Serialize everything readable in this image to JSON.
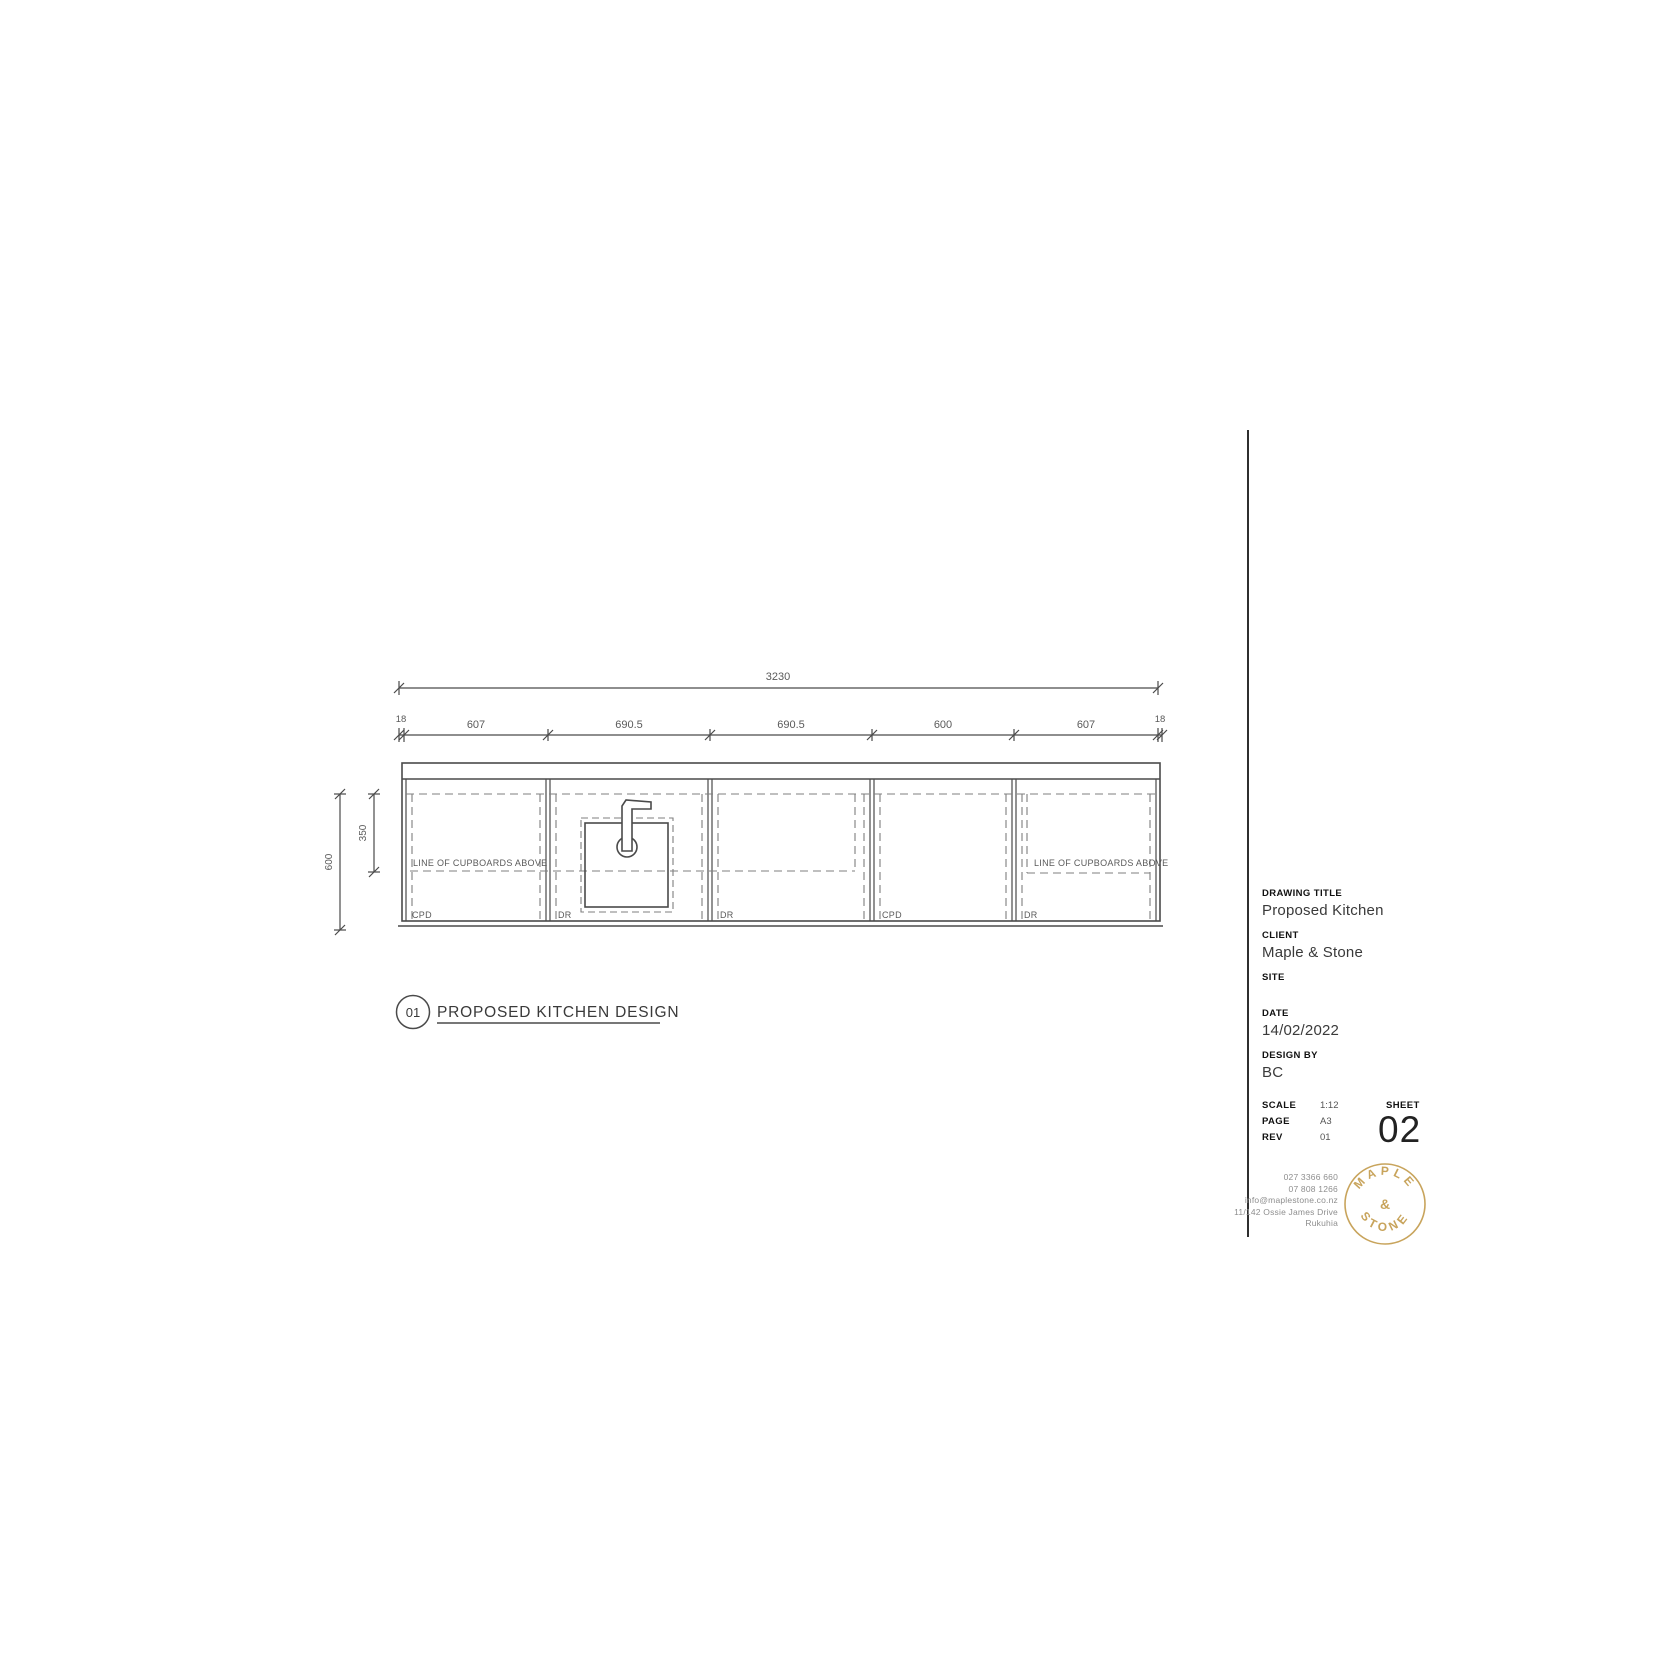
{
  "drawing": {
    "total_dim": "3230",
    "segment_dims": [
      "18",
      "607",
      "690.5",
      "690.5",
      "600",
      "607",
      "18"
    ],
    "height_dim": "600",
    "upper_dim": "350",
    "note_left": "LINE OF CUPBOARDS ABOVE",
    "note_right": "LINE OF CUPBOARDS ABOVE",
    "unit_labels": [
      "CPD",
      "DR",
      "DR",
      "CPD",
      "DR"
    ],
    "callout_number": "01",
    "callout_title": "PROPOSED KITCHEN DESIGN"
  },
  "title_block": {
    "drawing_title_label": "DRAWING TITLE",
    "drawing_title": "Proposed Kitchen",
    "client_label": "CLIENT",
    "client": "Maple & Stone",
    "site_label": "SITE",
    "date_label": "DATE",
    "date": "14/02/2022",
    "design_by_label": "DESIGN BY",
    "design_by": "BC",
    "scale_label": "SCALE",
    "scale": "1:12",
    "page_label": "PAGE",
    "page": "A3",
    "rev_label": "REV",
    "rev": "01",
    "sheet_label": "SHEET",
    "sheet": "02"
  },
  "contact": {
    "phone1": "027 3366 660",
    "phone2": "07 808 1266",
    "email": "info@maplestone.co.nz",
    "address1": "11/142 Ossie James Drive",
    "address2": "Rukuhia"
  },
  "logo": {
    "arc_top": "MAPLE",
    "ampersand": "&",
    "arc_bottom": "STONE",
    "color": "#C8A45C"
  },
  "colors": {
    "line": "#4a4a4a",
    "dashed": "#7f7f7f",
    "text": "#5a5a5a",
    "accent": "#C8A45C"
  }
}
